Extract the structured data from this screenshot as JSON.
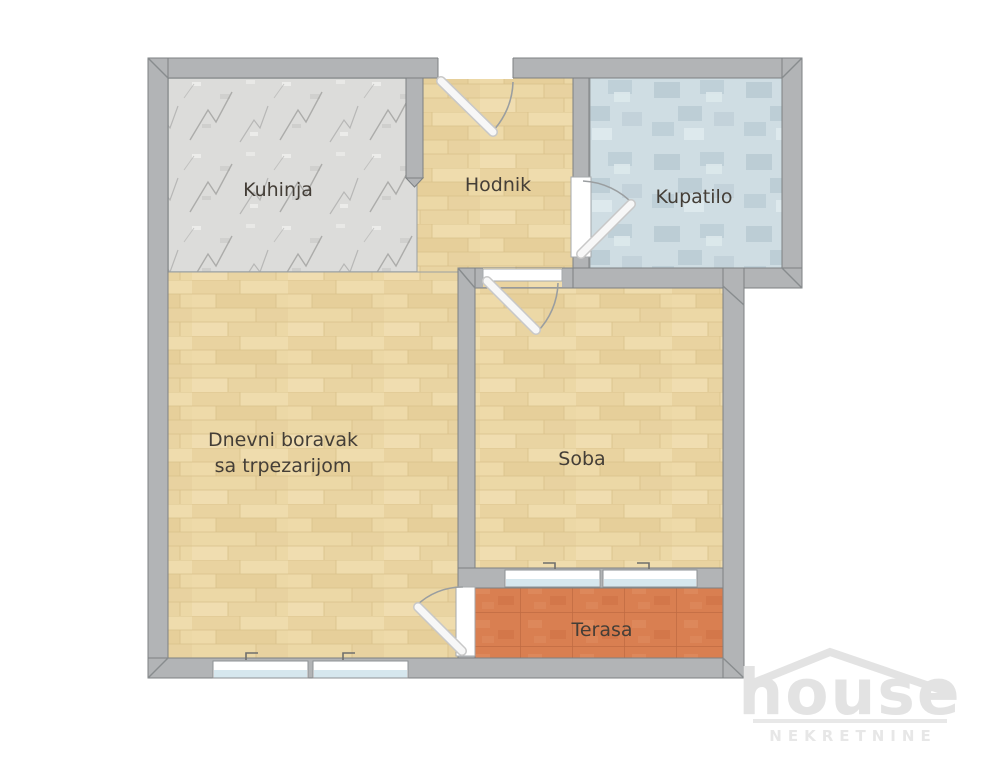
{
  "rooms": {
    "kuhinja": "Kuhinja",
    "hodnik": "Hodnik",
    "kupatilo": "Kupatilo",
    "dnevni_line1": "Dnevni boravak",
    "dnevni_line2": "sa trpezarijom",
    "soba": "Soba",
    "terasa": "Terasa"
  },
  "logo": {
    "brand": "house",
    "subtitle": "NEKRETNINE"
  },
  "colors": {
    "wall": "#b2b4b6",
    "wall_outline": "#7d8183",
    "wood_floor": "#ecd8a6",
    "stone_floor": "#dcdcda",
    "bath_tile": "#cfdde3",
    "terrace_tile": "#d97f51",
    "window_glass": "#d6e7ee",
    "label_text": "#443e37",
    "logo_gray": "#e3e3e3"
  }
}
